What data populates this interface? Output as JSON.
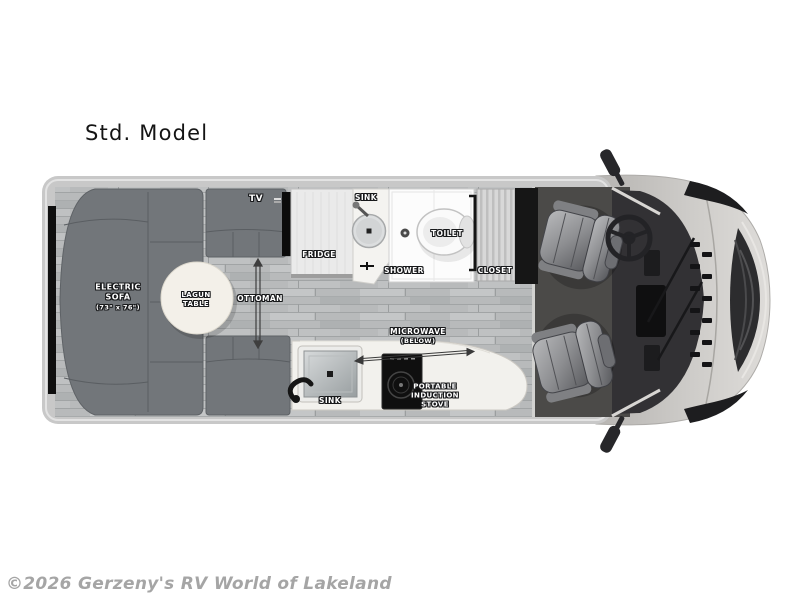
{
  "title": "Std. Model",
  "watermark": "©2026 Gerzeny's RV World of Lakeland",
  "floorplan": {
    "tv": {
      "label": "TV"
    },
    "sofa": {
      "line1": "ELECTRIC",
      "line2": "SOFA",
      "dims": "(73\" x 76\")"
    },
    "table": {
      "line1": "LAGUN",
      "line2": "TABLE"
    },
    "ottoman": {
      "label": "OTTOMAN"
    },
    "fridge": {
      "label": "FRIDGE"
    },
    "bath_sink": {
      "label": "SINK"
    },
    "shower": {
      "label": "SHOWER"
    },
    "toilet": {
      "label": "TOILET"
    },
    "closet": {
      "label": "CLOSET"
    },
    "microwave": {
      "label": "MICROWAVE",
      "note": "(BELOW)"
    },
    "galley_sink": {
      "label": "SINK"
    },
    "stove": {
      "line1": "PORTABLE",
      "line2": "INDUCTION",
      "line3": "STOVE"
    }
  },
  "colors": {
    "sofa_gray": "#72767a",
    "floor_wood": "#b8babb",
    "cab_carpet": "#4b4a48",
    "body_silver": "#c8c8c8",
    "counter_white": "#f2f1ed",
    "label_text": "#ffffff",
    "watermark_gray": "#a5a5a5"
  }
}
